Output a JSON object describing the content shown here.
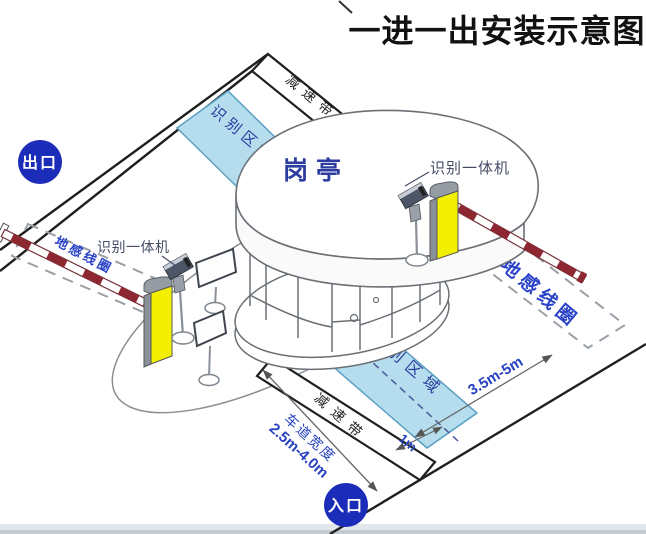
{
  "title": "一进一出安装示意图",
  "badges": {
    "exit": "出口",
    "entrance": "入口"
  },
  "booth": {
    "label": "岗亭"
  },
  "devices": {
    "camera_left_label": "识别一体机",
    "camera_right_label": "识别一体机"
  },
  "areas": {
    "recognition_top": "识别区域",
    "recognition_bottom": "识别区域",
    "coil_left": "地感线圈",
    "coil_right": "地感线圈"
  },
  "road": {
    "speed_bump_top": "减速带",
    "speed_bump_bottom": "减速带"
  },
  "dimensions": {
    "coil_distance": "3.5m-5m",
    "stop_line_offset": "1m",
    "lane_width_label": "车道宽度",
    "lane_width_value": "2.5m-4.0m"
  },
  "colors": {
    "recognition_fill": "#b5ddee",
    "recognition_stroke": "#5b9fc2",
    "navy_text": "#2b3b9e",
    "blue_text": "#2a42c8",
    "dim_text": "#2743c0",
    "badge_bg": "#1b2db8",
    "badge_text": "#ffffff",
    "arm_red": "#8d2732",
    "gate_yellow": "#f2ef00",
    "line": "#1f1f1f"
  }
}
